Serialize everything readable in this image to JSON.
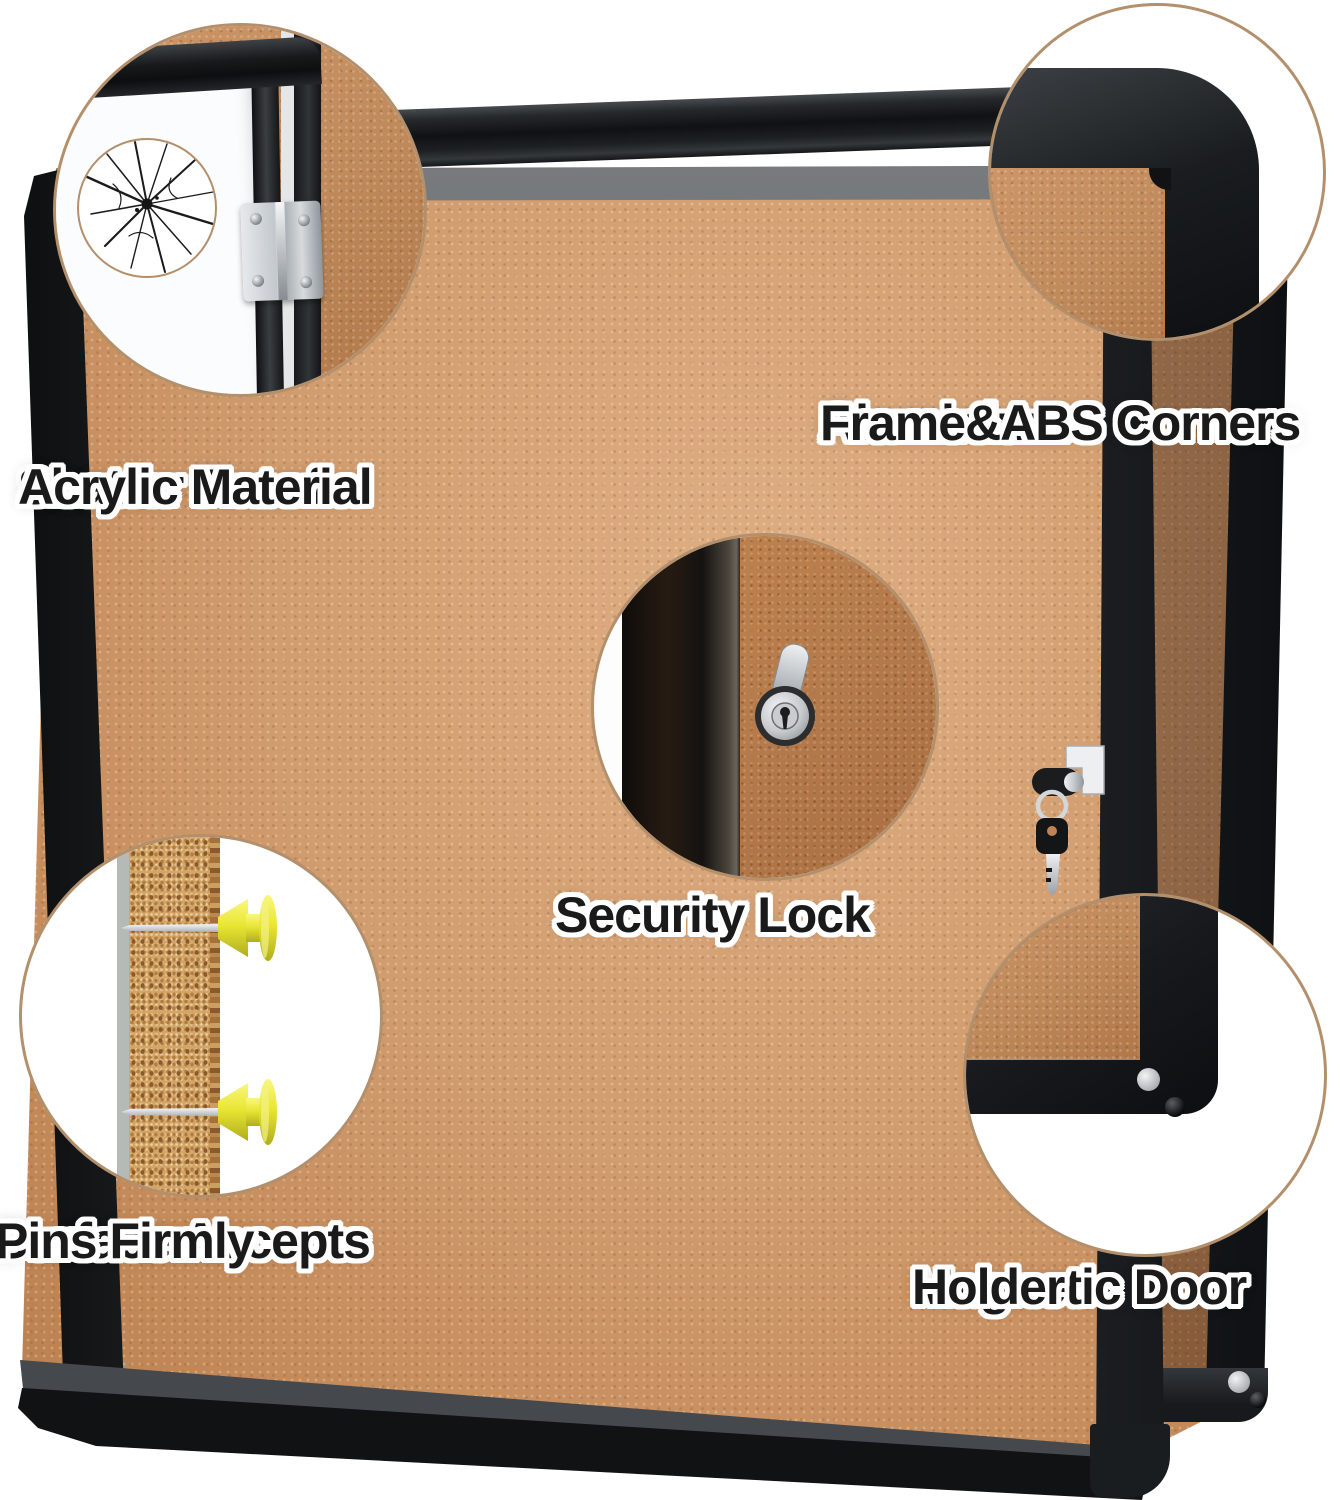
{
  "image_type": "product-feature-callout-photo",
  "background_color": "#ffffff",
  "palette": {
    "cork": "#cf9a6c",
    "frame_black": "#17191c",
    "inner_frame_gray": "#686b6e",
    "callout_ring": "#b3906b",
    "pushpin_yellow": "#e9e634",
    "key_silver": "#d9dcdf",
    "label_text": "#1a1a1a",
    "label_outline": "#ffffff"
  },
  "product": {
    "name": "enclosed cork bulletin board with lockable acrylic door",
    "visible_parts": [
      "cork-surface",
      "black-aluminium-frame",
      "acrylic-door",
      "door-hinge",
      "security-lock-with-key",
      "magnetic-door-holder",
      "yellow-push-pins"
    ]
  },
  "callouts": [
    {
      "id": "shatter-proof-acrylic",
      "lines": [
        "Shatter Proof",
        "Acrylic Material"
      ]
    },
    {
      "id": "aluminium-frame-abs-corners",
      "lines": [
        "Aluminium",
        "Frame&ABS Corners"
      ]
    },
    {
      "id": "security-lock",
      "lines": [
        "Security Lock"
      ]
    },
    {
      "id": "pins-surface",
      "lines": [
        "Surface Accepts",
        "Pins Firmly"
      ]
    },
    {
      "id": "magnetic-door-holder",
      "lines": [
        "Magnetic Door",
        "Holder"
      ]
    }
  ]
}
